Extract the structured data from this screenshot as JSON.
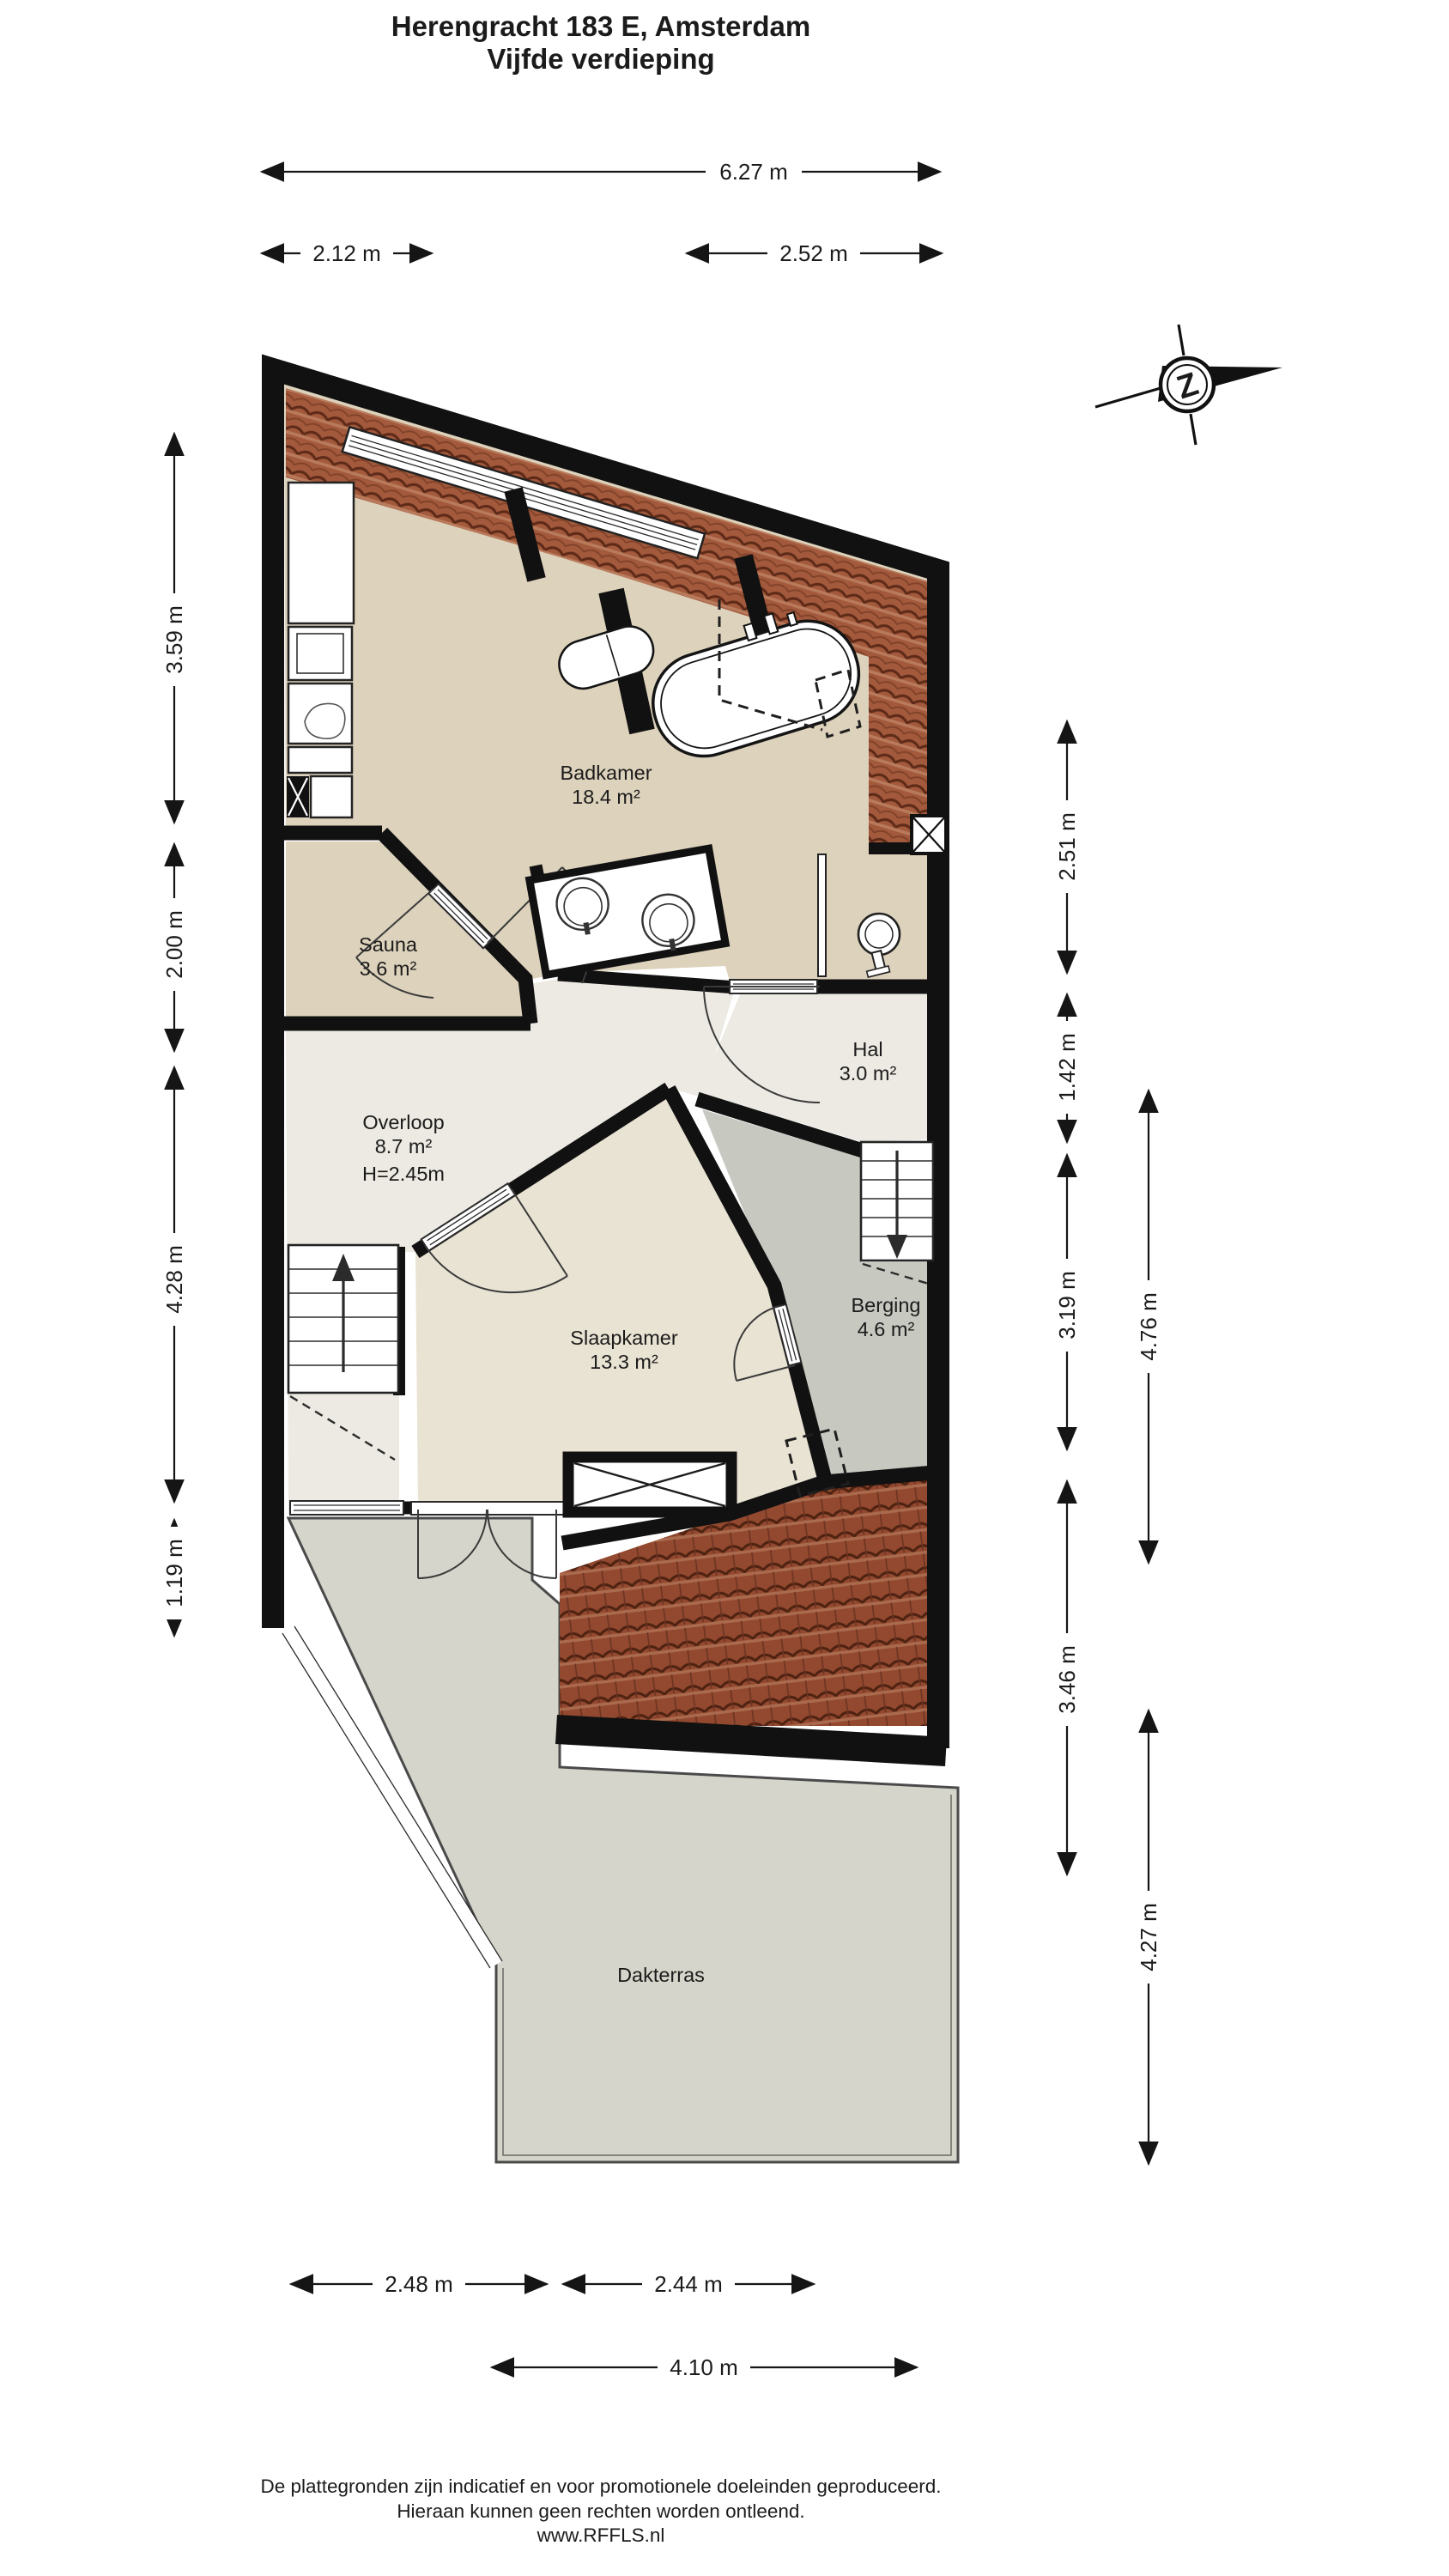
{
  "title": {
    "line1": "Herengracht 183 E, Amsterdam",
    "line2": "Vijfde verdieping"
  },
  "compass": {
    "letter": "Z"
  },
  "rooms": {
    "badkamer": {
      "name": "Badkamer",
      "area": "18.4 m²"
    },
    "sauna": {
      "name": "Sauna",
      "area": "3.6 m²"
    },
    "hal": {
      "name": "Hal",
      "area": "3.0 m²"
    },
    "overloop": {
      "name": "Overloop",
      "area": "8.7 m²",
      "height": "H=2.45m"
    },
    "slaapkamer": {
      "name": "Slaapkamer",
      "area": "13.3 m²"
    },
    "berging": {
      "name": "Berging",
      "area": "4.6 m²"
    },
    "dakterras": {
      "name": "Dakterras"
    }
  },
  "dimensions": {
    "top": [
      "6.27 m",
      "2.12 m",
      "2.52 m"
    ],
    "left": [
      "3.59 m",
      "2.00 m",
      "4.28 m",
      "1.19 m"
    ],
    "right_inner": [
      "2.51 m",
      "1.42 m",
      "3.19 m",
      "3.46 m"
    ],
    "right_outer": [
      "4.76 m",
      "4.27 m"
    ],
    "bottom": [
      "2.48 m",
      "2.44 m",
      "4.10 m"
    ]
  },
  "footer": {
    "line1": "De plattegronden zijn indicatief en voor promotionele doeleinden geproduceerd.",
    "line2": "Hieraan kunnen geen rechten worden ontleend.",
    "line3": "www.RFFLS.nl"
  },
  "colors": {
    "wall": "#111111",
    "bathroom_floor": "#ddd2bc",
    "landing_floor": "#eceae2",
    "bedroom_floor": "#e9e3d3",
    "storage_floor": "#c7c9c1",
    "terrace_floor": "#d5d5cb",
    "roof_tiles": "#a2593c"
  }
}
